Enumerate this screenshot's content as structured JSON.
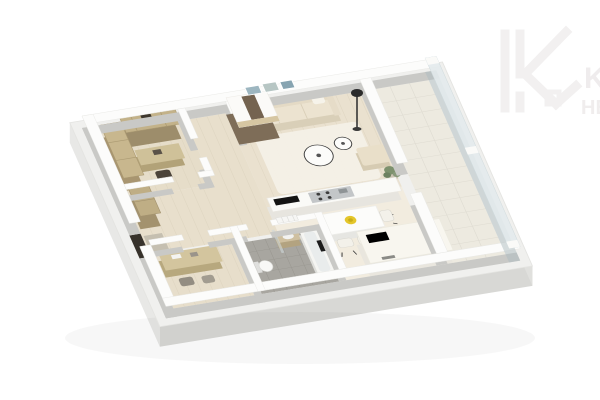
{
  "scene": {
    "kind": "3d-apartment-floor-plan-render",
    "background": "#ffffff"
  },
  "watermark": {
    "icon": "house-k-logo-icon",
    "line1": "KI",
    "line2": "HE",
    "color": "#efeDed"
  },
  "palette": {
    "wall_top": "#fcfcfb",
    "wall_side": "#c9c9c6",
    "slab_side": "#d8d8d5",
    "wood_floor": "#e8dfcc",
    "cream_floor": "#f2ecdf",
    "bath_tile": "#a8a6a0",
    "balcony_tile": "#edeae0",
    "glass": "#aebcc0",
    "furniture_wood": "#c3b289",
    "sofa_beige": "#ece3d0",
    "accent_black": "#141414",
    "bowl_yellow": "#e4c62a",
    "plant_green": "#7d916d"
  },
  "rooms": [
    {
      "name": "bedroom-office",
      "furniture": [
        "wardrobe",
        "wall-cabinets",
        "desk",
        "chair"
      ]
    },
    {
      "name": "hallway",
      "furniture": [
        "entry-door",
        "doormat",
        "hall-wardrobe"
      ]
    },
    {
      "name": "living-room",
      "furniture": [
        "sofa",
        "wall-art",
        "floor-lamp",
        "coffee-tables",
        "rug",
        "ottoman",
        "plant",
        "robot-vacuum",
        "entry-closet"
      ]
    },
    {
      "name": "kitchen-dining",
      "furniture": [
        "counter-cooktop",
        "tv-strip",
        "dining-table",
        "dining-chairs",
        "fruit-bowl",
        "kitchen-island"
      ]
    },
    {
      "name": "bathroom",
      "furniture": [
        "toilet",
        "washbasin",
        "shower-screen",
        "bathtub",
        "towel",
        "radiator"
      ]
    },
    {
      "name": "home-office",
      "furniture": [
        "desk",
        "chairs"
      ]
    },
    {
      "name": "balcony",
      "furniture": [
        "glass-railing"
      ]
    }
  ]
}
